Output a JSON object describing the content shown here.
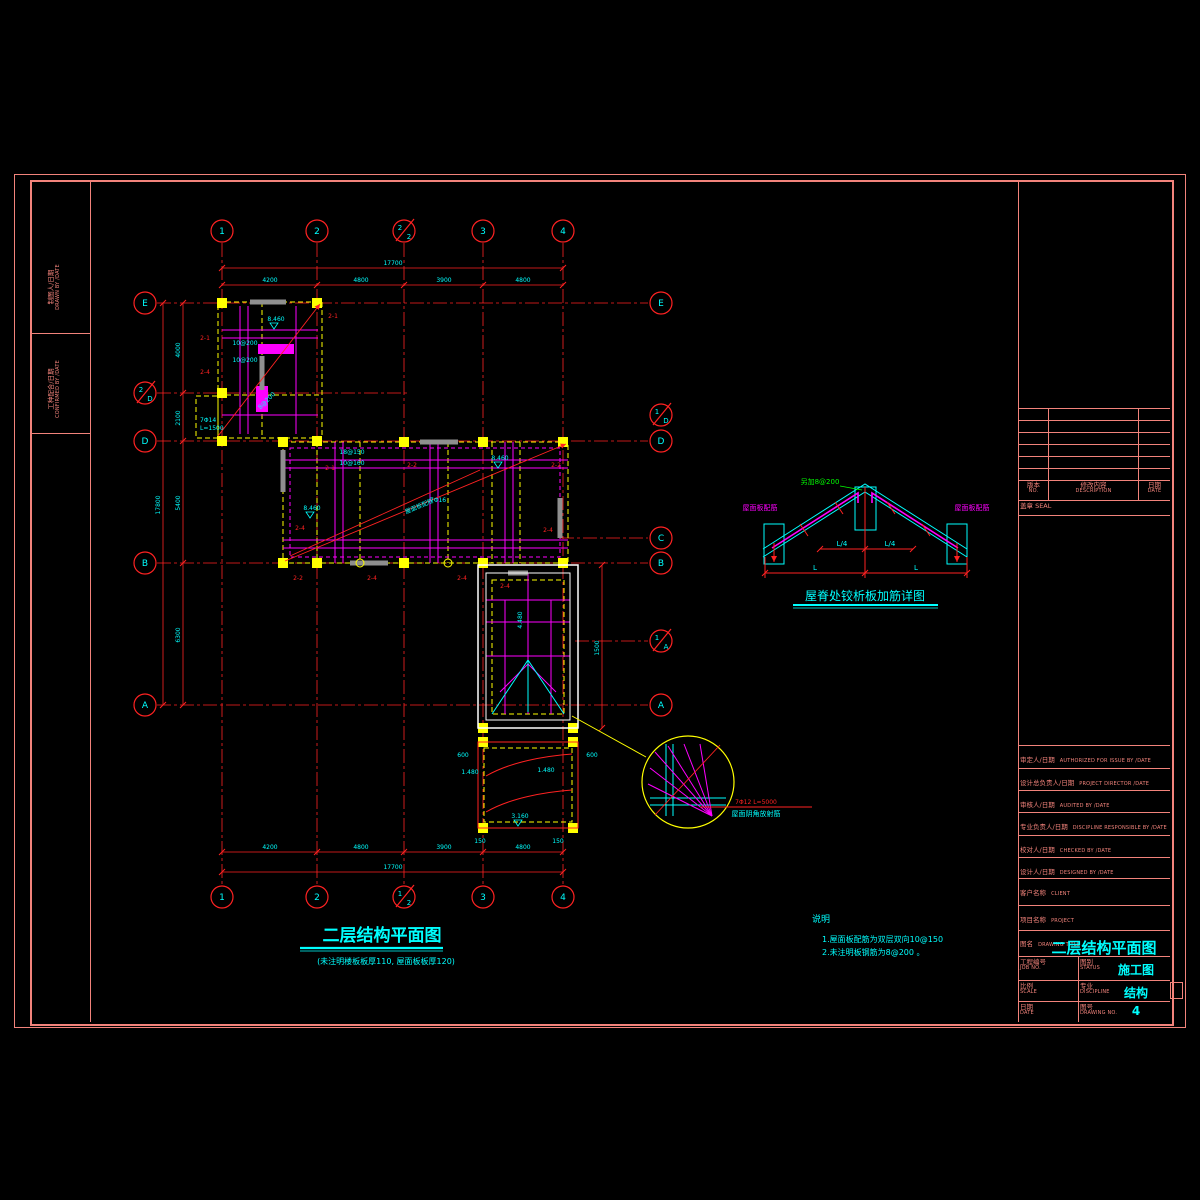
{
  "colors": {
    "background": "#000000",
    "frame": "#f2837b",
    "grid": "#ff0000",
    "rebar": "#ff00ff",
    "slab_edge": "#ffff00",
    "annotation": "#00ffff",
    "added_bar": "#00ff00",
    "wall": "#8f8f8f",
    "outline": "#ffffff"
  },
  "left_strip": {
    "drawn_cn": "制图人/日期",
    "drawn_en": "DRAWN BY /DATE",
    "confirmed_cn": "工种配合/日期",
    "confirmed_en": "CONFIRMED BY /DATE"
  },
  "plan": {
    "title": "二层结构平面图",
    "subtitle": "(未注明楼板板厚110, 屋面板板厚120)",
    "axes_top": [
      "1",
      "2",
      "3",
      "4"
    ],
    "axes_top_extra_num": "2",
    "axes_top_extra_den": "2",
    "axes_bottom_extra_num": "1",
    "axes_bottom_extra_den": "2",
    "axes_left": [
      "E",
      "D",
      "B",
      "A"
    ],
    "axes_left_extra_num": "2",
    "axes_left_extra_den": "D",
    "axes_right": [
      "E",
      "D",
      "C",
      "B",
      "A"
    ],
    "axes_right_extra1_num": "1",
    "axes_right_extra1_den": "D",
    "axes_right_extra2_num": "1",
    "axes_right_extra2_den": "A",
    "dims": {
      "top_overall": "17700",
      "top_segments": [
        "4200",
        "4800",
        "3900",
        "4800"
      ],
      "bottom_overall": "17700",
      "bottom_segments": [
        "4200",
        "4800",
        "3900",
        "4800"
      ],
      "left_overall": "17800",
      "left_segments": [
        "4000",
        "2100",
        "5400",
        "6300"
      ],
      "right_height": "1500",
      "d600a": "600",
      "d600b": "600",
      "d150a": "150",
      "d150b": "150"
    },
    "beams": [
      "2-1",
      "2-1",
      "2-4",
      "2-1",
      "2-2",
      "2-2",
      "2-4",
      "2-4",
      "2-2",
      "2-4",
      "2-4",
      "2-4"
    ],
    "bars": [
      "10@200",
      "10@200",
      "18@150",
      "10@160",
      "7Φ16",
      "8@200"
    ],
    "elevations": [
      "8.460",
      "8.460",
      "8.460",
      "4.480",
      "1.480",
      "1.480",
      "3.160"
    ],
    "slope_label": "屋面板配筋",
    "extra_bar_1": "7Φ14",
    "extra_bar_2": "L=1500",
    "corner_detail": {
      "bar": "7Φ12  L=5000",
      "label": "屋面阴角放射筋"
    }
  },
  "ridge_detail": {
    "title": "屋脊处铰析板加筋详图",
    "add_bar": "另加8@200",
    "left_label": "屋面板配筋",
    "right_label": "屋面板配筋",
    "l4a": "L/4",
    "l4b": "L/4",
    "la": "L",
    "lb": "L"
  },
  "notes": {
    "heading": "说明",
    "item1": "1.屋面板配筋为双层双向10@150",
    "item2": "2.未注明板钢筋为8@200  。"
  },
  "titleblock": {
    "rev_no_cn": "版本",
    "rev_no_en": "NO.",
    "rev_desc_cn": "修改内容",
    "rev_desc_en": "DESCRIPTION",
    "rev_date_cn": "日期",
    "rev_date_en": "DATE",
    "seal": "盖章 SEAL",
    "rows": [
      {
        "cn": "审定人/日期",
        "en": "AUTHORIZED FOR ISSUE BY /DATE"
      },
      {
        "cn": "设计总负责人/日期",
        "en": "PROJECT DIRECTOR /DATE"
      },
      {
        "cn": "审核人/日期",
        "en": "AUDITED BY /DATE"
      },
      {
        "cn": "专业负责人/日期",
        "en": "DISCIPLINE RESPONSIBLE BY /DATE"
      },
      {
        "cn": "校对人/日期",
        "en": "CHECKED BY /DATE"
      },
      {
        "cn": "设计人/日期",
        "en": "DESIGNED BY /DATE"
      },
      {
        "cn": "客户名称",
        "en": "CLIENT"
      },
      {
        "cn": "项目名称",
        "en": "PROJECT"
      }
    ],
    "title_label_cn": "图名",
    "title_label_en": "DRAWING TITLE",
    "title_value": "二层结构平面图",
    "job_cn": "工程编号",
    "job_en": "JOB NO.",
    "status_cn": "图别",
    "status_en": "STATUS",
    "status_value": "施工图",
    "scale_cn": "比例",
    "scale_en": "SCALE",
    "disc_cn": "专业",
    "disc_en": "DISCIPLINE",
    "disc_value": "结构",
    "date_cn": "日期",
    "date_en": "DATE",
    "no_cn": "图号",
    "no_en": "DRAWING NO.",
    "no_value": "4"
  }
}
